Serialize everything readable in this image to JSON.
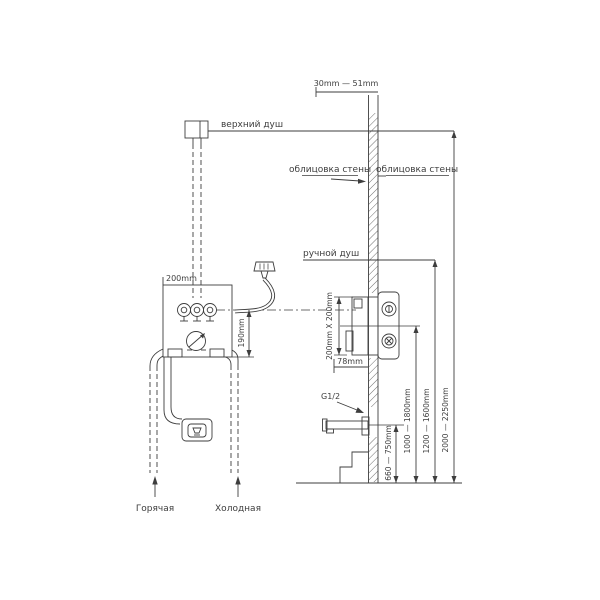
{
  "drawing": {
    "labels": {
      "top_shower": "верхний душ",
      "hand_shower": "ручной душ",
      "wall_cladding_left": "облицовка стены",
      "wall_cladding_right": "облицовка стены",
      "hot_supply": "Горячая",
      "cold_supply": "Холодная",
      "thread_size": "G1/2"
    },
    "dimensions": {
      "cladding_thickness_range": "30mm — 51mm",
      "box_width": "200mm",
      "box_height": "190mm",
      "rough_in_opening": "200mm X 200mm",
      "box_depth": "78mm",
      "spout_height_range": "660 — 750mm",
      "mixer_height_range": "1000 — 1800mm",
      "hand_shower_height_range": "1200 — 1600mm",
      "top_shower_height_range": "2000 — 2250mm"
    },
    "colors": {
      "background": "#ffffff",
      "line": "#3d3d3d"
    }
  }
}
